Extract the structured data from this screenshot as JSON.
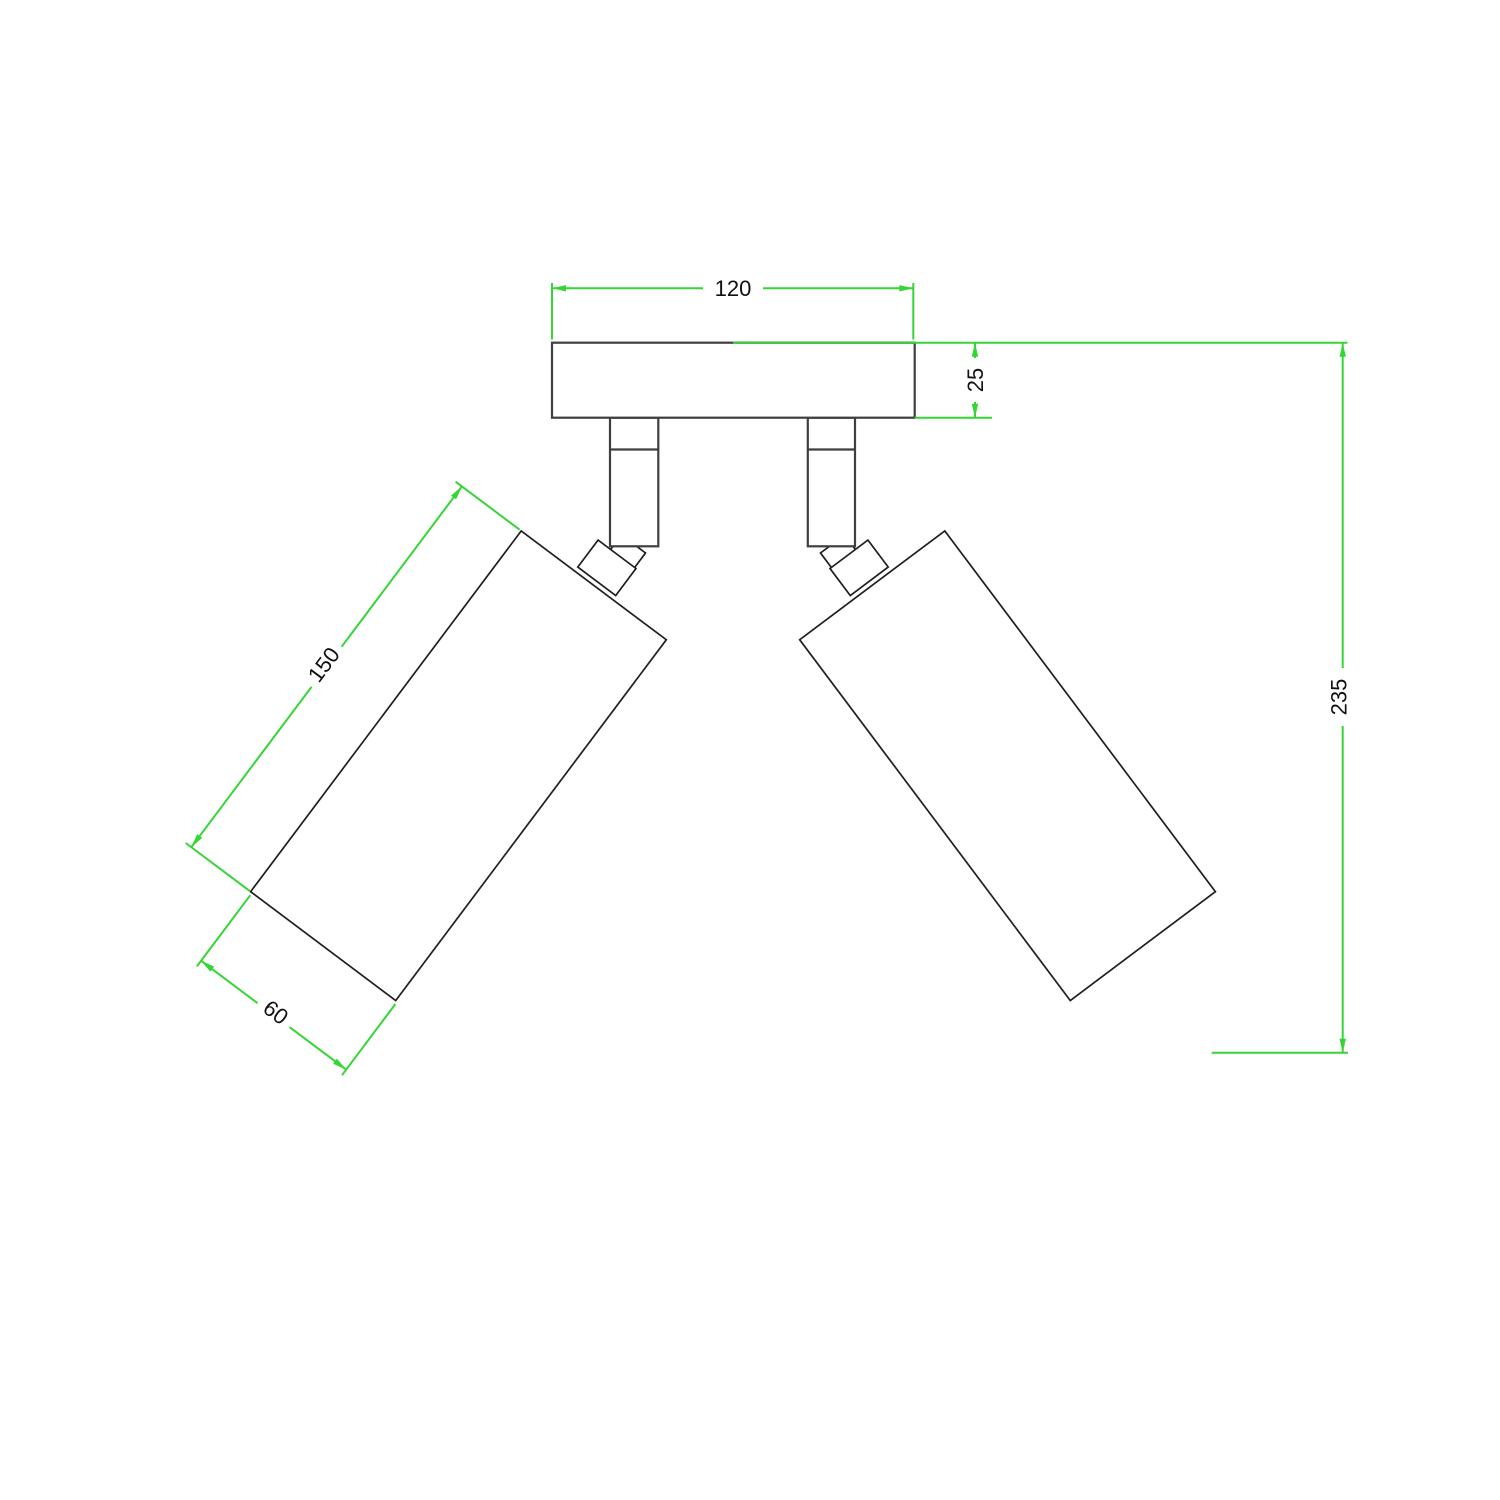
{
  "drawing": {
    "kind": "technical-dimension-drawing",
    "views": "front elevation of a two-head adjustable spotlight ceiling lamp"
  },
  "colors": {
    "dimension_lines": "#35d535",
    "outline_primary": "#3f3f3f",
    "outline_secondary": "#1f1f1f",
    "background": "#ffffff",
    "text": "#111111"
  },
  "dimensions": {
    "plate_width": {
      "label": "120"
    },
    "plate_thickness": {
      "label": "25"
    },
    "shade_length": {
      "label": "150"
    },
    "shade_width": {
      "label": "60"
    },
    "overall_height": {
      "label": "235"
    }
  }
}
